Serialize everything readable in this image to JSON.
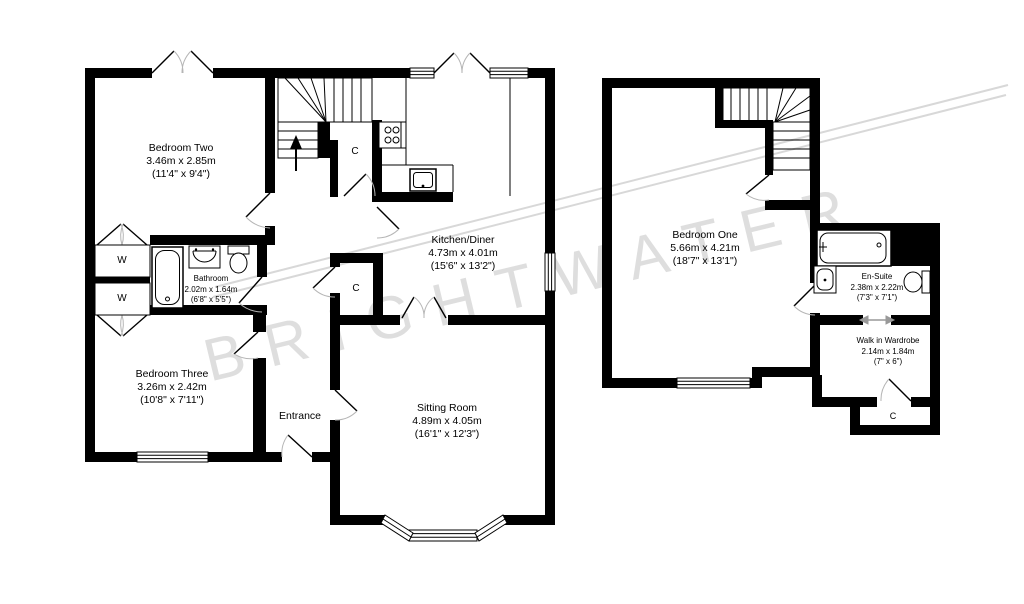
{
  "watermark": {
    "text": "BRIGHTWATER",
    "color": "#dedede"
  },
  "colors": {
    "wall": "#000000",
    "floor": "#ffffff",
    "door_arc": "#b5b5b5",
    "watermark_line": "#d8d8d8"
  },
  "ground_floor": {
    "rooms": [
      {
        "id": "bedroom-two",
        "name": "Bedroom Two",
        "metric": "3.46m x 2.85m",
        "imperial": "(11'4\" x 9'4\")"
      },
      {
        "id": "kitchen-diner",
        "name": "Kitchen/Diner",
        "metric": "4.73m x 4.01m",
        "imperial": "(15'6\" x 13'2\")"
      },
      {
        "id": "bathroom",
        "name": "Bathroom",
        "metric": "2.02m x 1.64m",
        "imperial": "(6'8\" x 5'5\")"
      },
      {
        "id": "bedroom-three",
        "name": "Bedroom Three",
        "metric": "3.26m x 2.42m",
        "imperial": "(10'8\" x 7'11\")"
      },
      {
        "id": "sitting-room",
        "name": "Sitting Room",
        "metric": "4.89m x 4.05m",
        "imperial": "(16'1\" x 12'3\")"
      },
      {
        "id": "entrance",
        "name": "Entrance"
      }
    ],
    "closets": {
      "understairs": "C",
      "hall": "C"
    },
    "wardrobes": {
      "top": "W",
      "bottom": "W"
    }
  },
  "first_floor": {
    "rooms": [
      {
        "id": "bedroom-one",
        "name": "Bedroom One",
        "metric": "5.66m x 4.21m",
        "imperial": "(18'7\" x 13'1\")"
      },
      {
        "id": "en-suite",
        "name": "En-Suite",
        "metric": "2.38m x 2.22m",
        "imperial": "(7'3\" x 7'1\")"
      },
      {
        "id": "walk-in-wardrobe",
        "name": "Walk in Wardrobe",
        "metric": "2.14m x 1.84m",
        "imperial": "(7\" x 6\")"
      }
    ],
    "closets": {
      "cupboard": "C"
    }
  }
}
